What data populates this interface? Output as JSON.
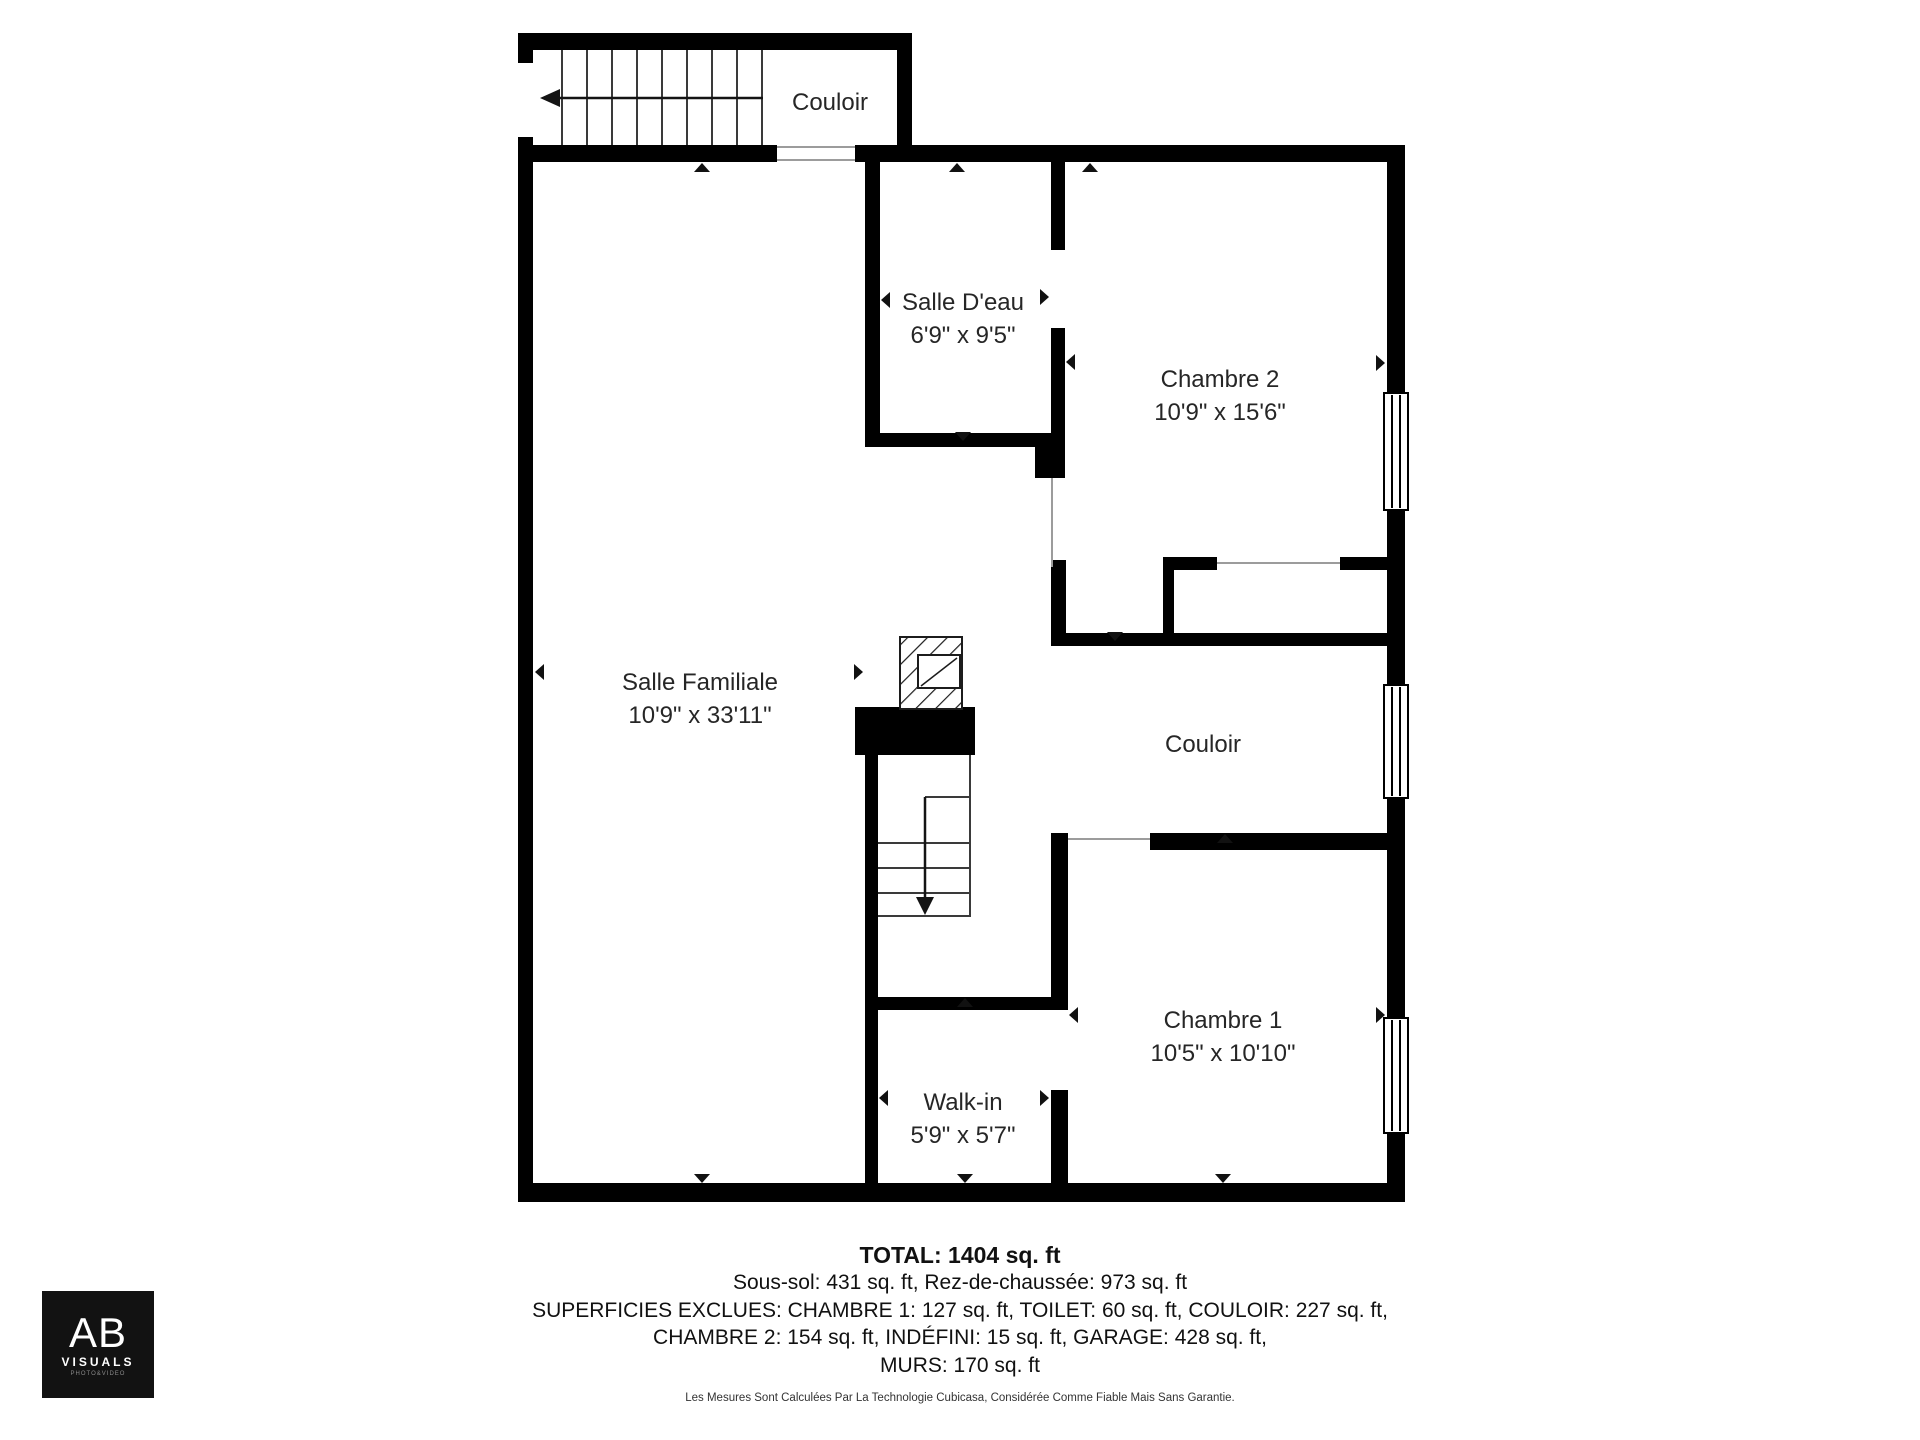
{
  "floorplan": {
    "wall_color": "#000000",
    "rooms": {
      "couloir_top": {
        "name": "Couloir"
      },
      "salle_deau": {
        "name": "Salle D'eau",
        "dimensions": "6'9\" x 9'5\""
      },
      "chambre2": {
        "name": "Chambre 2",
        "dimensions": "10'9\" x 15'6\""
      },
      "salle_familiale": {
        "name": "Salle Familiale",
        "dimensions": "10'9\" x 33'11\""
      },
      "couloir_mid": {
        "name": "Couloir"
      },
      "chambre1": {
        "name": "Chambre 1",
        "dimensions": "10'5\" x 10'10\""
      },
      "walk_in": {
        "name": "Walk-in",
        "dimensions": "5'9\" x 5'7\""
      }
    }
  },
  "summary": {
    "total": "TOTAL: 1404 sq. ft",
    "areas_line": "Sous-sol: 431 sq. ft, Rez-de-chaussée: 973 sq. ft",
    "excluded_line1": "SUPERFICIES EXCLUES: CHAMBRE 1: 127 sq. ft, TOILET: 60 sq. ft, COULOIR: 227 sq. ft,",
    "excluded_line2": "CHAMBRE 2: 154 sq. ft, INDÉFINI: 15 sq. ft, GARAGE: 428 sq. ft,",
    "excluded_line3": "MURS: 170 sq. ft",
    "disclaimer": "Les Mesures Sont Calculées Par La Technologie Cubicasa, Considérée Comme Fiable Mais Sans Garantie."
  },
  "logo": {
    "initials": "AB",
    "brand": "VISUALS",
    "tagline": "PHOTO&VIDEO"
  }
}
